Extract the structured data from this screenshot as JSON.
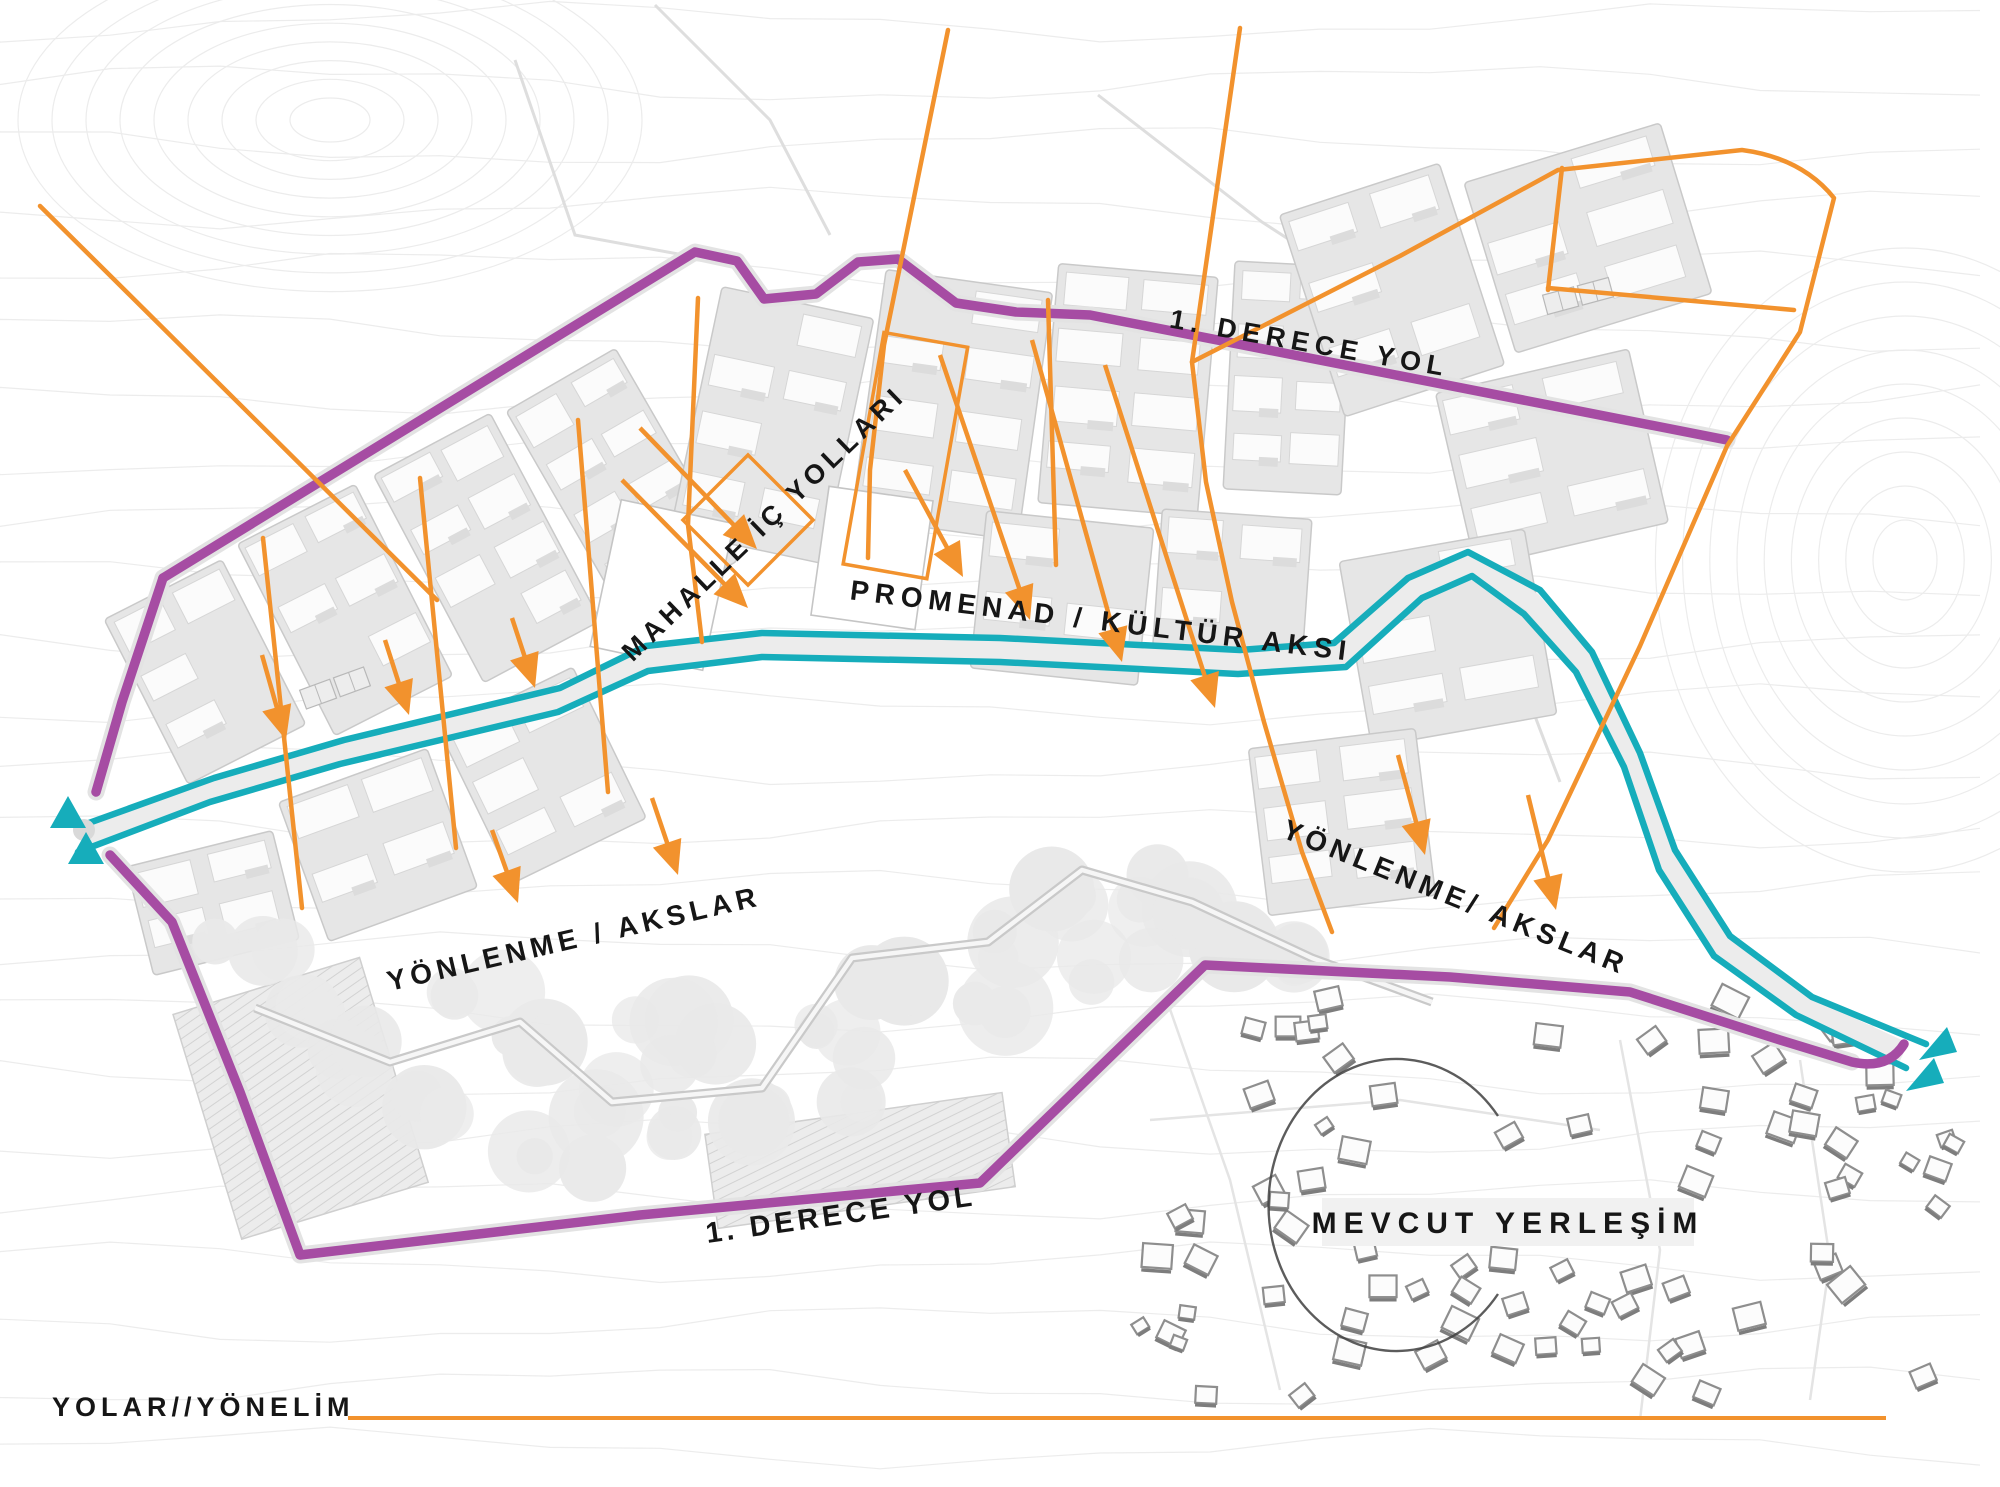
{
  "title": {
    "text": "YOLAR//YÖNELİM"
  },
  "colors": {
    "purple": "#A64CA3",
    "teal": "#16ADBB",
    "orange": "#F2922D",
    "ink": "#161616",
    "contour": "#ECECEC"
  },
  "map_labels": {
    "primary_road_top": "1. DERECE YOL",
    "primary_road_bottom": "1. DERECE YOL",
    "neighborhood_roads": "MAHALLE İÇ YOLLARI",
    "promenade_axis": "PROMENAD / KÜLTÜR AKSI",
    "orientation_axes_left": "YÖNLENME / AKSLAR",
    "orientation_axes_right": "YÖNLENME/ AKSLAR",
    "existing_settlement": "MEVCUT YERLEŞİM"
  }
}
